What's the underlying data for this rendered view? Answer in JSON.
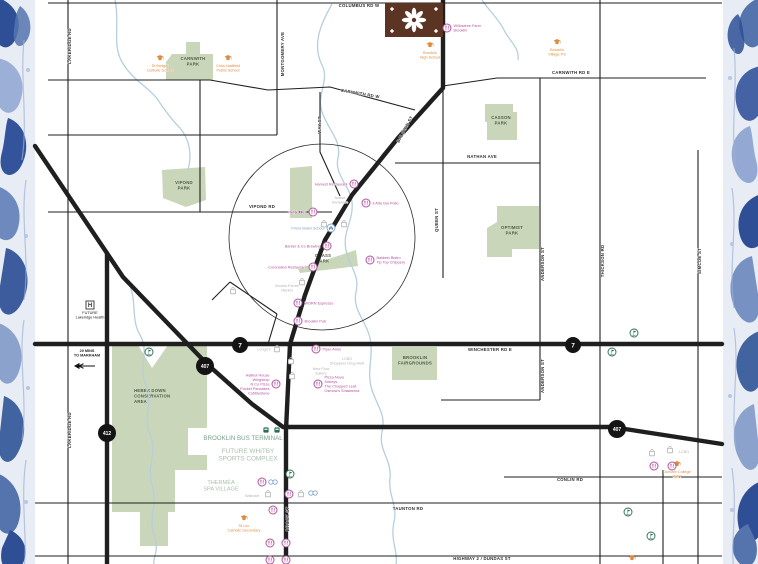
{
  "map_title": "Brooklin Whitby area amenities map",
  "colors": {
    "pink": "#b2519e",
    "orange": "#dd8c3f",
    "gray": "#b4b4b4",
    "blue": "#7fa6c9",
    "teal": "#79a189",
    "tealLight": "#a9c0ae",
    "black": "#222222",
    "green": "#2a6f4e",
    "park_fill": "#c9d6ba",
    "park_text": "#4e5c46",
    "road": "#1f1f1f",
    "stream": "#b6cede",
    "badge": "#141414",
    "logo_brown": "#5b3423"
  },
  "logo": {
    "x": 385,
    "y": 3,
    "w": 58,
    "h": 34
  },
  "circle": {
    "cx": 322,
    "cy": 237,
    "r": 93
  },
  "badges": [
    {
      "t": "7",
      "x": 240,
      "y": 345,
      "r": 8,
      "fs": 6.5
    },
    {
      "t": "7",
      "x": 573,
      "y": 345,
      "r": 8,
      "fs": 6.5
    },
    {
      "t": "407",
      "x": 205,
      "y": 366,
      "r": 9,
      "fs": 5
    },
    {
      "t": "407",
      "x": 617,
      "y": 429,
      "r": 9,
      "fs": 5
    },
    {
      "t": "412",
      "x": 107,
      "y": 433,
      "r": 9,
      "fs": 5
    }
  ],
  "roads": {
    "thin": [
      "M48,3 H722",
      "M68,0 V564",
      "M48,80 H210 L268,90 L330,87 L415,110",
      "M443,86 L497,78 H706",
      "M277,0 V135",
      "M48,135 H277",
      "M200,80 V212",
      "M48,212 H332",
      "M320,92 V152 L340,196",
      "M395,163 H540",
      "M443,90 V278",
      "M540,78 V400",
      "M600,0 V564",
      "M698,150 V564",
      "M441,400 H540",
      "M504,477 H722",
      "M663,470 V564",
      "M35,503 H722",
      "M35,556 H722",
      "M230,282 L277,314",
      "M277,314 L268,344",
      "M230,282 L212,300"
    ],
    "thick": [
      "M443,0 V88 L398,138 L352,195 L325,240 L305,295 L290,344 L286,430 V564",
      "M35,344 H722",
      "M35,146 L123,277 L207,364 L252,404 L283,427 H612 L722,444",
      "M107,253 V564"
    ]
  },
  "streams": [
    "M115,0 C120,25 112,45 122,62 C132,80 150,88 158,100 C166,112 172,120 180,128 C190,140 192,155 188,170",
    "M332,4 C320,25 312,45 322,65 C330,80 316,95 322,112 C328,130 342,140 338,158 C334,175 350,185 352,202 C354,220 342,232 346,250 C350,268 360,275 356,292 C352,310 366,320 370,338 C374,356 366,372 372,390 C378,408 386,414 382,432 C378,450 392,460 390,478 C388,496 398,505 394,522 C390,540 398,550 396,564",
    "M128,282 C138,300 130,318 140,335 C150,352 138,368 146,385 C154,402 142,418 150,435 C158,452 146,468 152,485 C158,502 148,518 154,535 C160,552 152,558 154,564",
    "M482,0 C490,12 498,18 504,30 C510,42 520,48 518,60"
  ],
  "parks": [
    {
      "label": [
        "CARNWITH",
        "PARK"
      ],
      "lx": 193,
      "ly": 60,
      "anchor": "middle",
      "d": "M172,54 L186,54 L186,42 L200,42 L200,54 L213,54 L213,80 L166,80 L166,62 Z"
    },
    {
      "label": [
        "VIPOND",
        "PARK"
      ],
      "lx": 184,
      "ly": 184,
      "anchor": "middle",
      "d": "M162,170 L205,167 L206,200 L186,207 L163,198 Z"
    },
    {
      "label": [
        "CASSON",
        "PARK"
      ],
      "lx": 501,
      "ly": 119,
      "anchor": "middle",
      "d": "M485,104 L513,104 L513,112 L517,112 L517,140 L487,140 L487,122 L485,122 Z"
    },
    {
      "label": [
        "OPTIMIST",
        "PARK"
      ],
      "lx": 512,
      "ly": 229,
      "anchor": "middle",
      "d": "M497,206 L539,206 L539,249 L512,249 L512,257 L487,257 L487,228 L497,222 Z"
    },
    {
      "label": [
        "GRASS",
        "PARK"
      ],
      "lx": 323,
      "ly": 257,
      "anchor": "middle",
      "d": "M298,269 L356,250 L358,266 L300,273 Z"
    },
    {
      "label": [
        "BROOKLIN",
        "FAIRGROUNDS"
      ],
      "lx": 415,
      "ly": 359,
      "anchor": "middle",
      "d": "M392,347 L437,347 L437,380 L392,380 Z"
    },
    {
      "label": [
        "HEBER DOWN",
        "CONSERVATION",
        "AREA"
      ],
      "lx": 134,
      "ly": 392,
      "anchor": "start",
      "d": "M112,345 L138,345 L152,368 L168,345 L207,345 L207,428 L188,428 L188,455 L207,455 L207,470 L175,470 L175,512 L168,512 L168,546 L140,546 L140,512 L112,512 Z"
    },
    {
      "label": [],
      "lx": 0,
      "ly": 0,
      "anchor": "middle",
      "d": "M290,168 L312,166 L312,218 L290,218 Z"
    }
  ],
  "streets": [
    {
      "t": "COLUMBUS RD W",
      "x": 359,
      "y": 7,
      "r": 0
    },
    {
      "t": "LAKERIDGE RD",
      "x": 71,
      "y": 46,
      "r": -90
    },
    {
      "t": "LAKERIDGE RD",
      "x": 71,
      "y": 430,
      "r": -90
    },
    {
      "t": "MONTGOMERY AVE",
      "x": 284,
      "y": 54,
      "r": -90
    },
    {
      "t": "CARNWITH RD W",
      "x": 360,
      "y": 95,
      "r": 10
    },
    {
      "t": "CARNWITH RD E",
      "x": 571,
      "y": 74,
      "r": 0
    },
    {
      "t": "WAY ST",
      "x": 321,
      "y": 125,
      "r": -90
    },
    {
      "t": "BALDWIN ST",
      "x": 406,
      "y": 130,
      "r": -62
    },
    {
      "t": "VIPOND RD",
      "x": 262,
      "y": 208,
      "r": 0
    },
    {
      "t": "NATHAN AVE",
      "x": 482,
      "y": 158,
      "r": 0
    },
    {
      "t": "QUEEN ST",
      "x": 438,
      "y": 220,
      "r": -90
    },
    {
      "t": "ANDERSON ST",
      "x": 544,
      "y": 264,
      "r": -90
    },
    {
      "t": "ANDERSON ST",
      "x": 544,
      "y": 376,
      "r": -90
    },
    {
      "t": "THICKSON RD",
      "x": 604,
      "y": 261,
      "r": -90
    },
    {
      "t": "SIMCOE ST",
      "x": 701,
      "y": 261,
      "r": -90
    },
    {
      "t": "WINCHESTER RD E",
      "x": 490,
      "y": 351,
      "r": 0
    },
    {
      "t": "CONLIN RD",
      "x": 570,
      "y": 481,
      "r": 0
    },
    {
      "t": "TAUNTON RD",
      "x": 408,
      "y": 510,
      "r": 0
    },
    {
      "t": "HIGHWAY 2 / DUNDAS ST",
      "x": 482,
      "y": 560,
      "r": 0
    },
    {
      "t": "BROCK ST",
      "x": 289,
      "y": 519,
      "r": -90
    }
  ],
  "pois": [
    {
      "type": "school",
      "x": 160,
      "y": 58,
      "side": "b",
      "color": "orange",
      "label": [
        "St Bridget",
        "Catholic School"
      ]
    },
    {
      "type": "school",
      "x": 228,
      "y": 58,
      "side": "b",
      "color": "orange",
      "label": [
        "Chris Hadfield",
        "Public School"
      ]
    },
    {
      "type": "school",
      "x": 430,
      "y": 45,
      "side": "b",
      "color": "orange",
      "label": [
        "Brooklin",
        "High School"
      ]
    },
    {
      "type": "school",
      "x": 557,
      "y": 42,
      "side": "b",
      "color": "orange",
      "label": [
        "Brooklin",
        "Village PS"
      ]
    },
    {
      "type": "school",
      "x": 244,
      "y": 518,
      "side": "b",
      "color": "orange",
      "label": [
        "St Leo",
        "Catholic Secondary"
      ]
    },
    {
      "type": "school",
      "x": 677,
      "y": 464,
      "side": "b",
      "color": "orange",
      "label": [
        "Durham College",
        "UOIT"
      ]
    },
    {
      "type": "school",
      "x": 632,
      "y": 558,
      "side": "b",
      "color": "orange",
      "label": []
    },
    {
      "type": "hospital",
      "x": 90,
      "y": 305,
      "side": "b",
      "color": "black",
      "label": [
        "FUTURE",
        "Lakeridge Health"
      ]
    },
    {
      "type": "restaurant",
      "x": 447,
      "y": 28,
      "side": "r",
      "color": "pink",
      "label": [
        "Willowtree Farm",
        "Brooklin"
      ]
    },
    {
      "type": "restaurant",
      "x": 354,
      "y": 184,
      "side": "l",
      "color": "pink",
      "label": [
        "Harvest Restaurant"
      ]
    },
    {
      "type": "restaurant",
      "x": 313,
      "y": 212,
      "side": "l",
      "color": "pink",
      "label": [
        "Holly's Deli"
      ]
    },
    {
      "type": "text",
      "x": 340,
      "y": 199,
      "color": "gray",
      "label": [
        "Native",
        "Hardware"
      ]
    },
    {
      "type": "bag",
      "x": 324,
      "y": 224,
      "color": "gray",
      "label": []
    },
    {
      "type": "bag",
      "x": 344,
      "y": 224,
      "color": "gray",
      "label": []
    },
    {
      "type": "car",
      "x": 331,
      "y": 228,
      "side": "l",
      "color": "blue",
      "label": [
        "Prima Ballet School"
      ]
    },
    {
      "type": "restaurant",
      "x": 366,
      "y": 203,
      "side": "r",
      "color": "pink",
      "label": [
        "Il Arte Del Pollo"
      ]
    },
    {
      "type": "restaurant",
      "x": 370,
      "y": 260,
      "side": "r",
      "color": "pink",
      "label": [
        "Baldwin Bistro",
        "Tip Top Chippery"
      ]
    },
    {
      "type": "restaurant",
      "x": 327,
      "y": 246,
      "side": "l",
      "color": "pink",
      "label": [
        "Barber & Co Brewing"
      ]
    },
    {
      "type": "restaurant",
      "x": 313,
      "y": 267,
      "side": "l",
      "color": "pink",
      "label": [
        "Coronation Restaurant"
      ]
    },
    {
      "type": "bag",
      "x": 302,
      "y": 282,
      "color": "gray",
      "label": []
    },
    {
      "type": "bag",
      "x": 233,
      "y": 291,
      "color": "gray",
      "label": []
    },
    {
      "type": "text",
      "x": 287,
      "y": 287,
      "color": "gray",
      "label": [
        "Brooks Farms",
        "Market"
      ]
    },
    {
      "type": "restaurant",
      "x": 298,
      "y": 303,
      "side": "r",
      "color": "pink",
      "label": [
        "WORN Espresso"
      ]
    },
    {
      "type": "restaurant",
      "x": 298,
      "y": 321,
      "side": "r",
      "color": "pink",
      "label": [
        "Brooklin Pub"
      ]
    },
    {
      "type": "bag",
      "x": 277,
      "y": 349,
      "side": "l",
      "color": "gray",
      "label": [
        "Longo's"
      ]
    },
    {
      "type": "restaurant",
      "x": 316,
      "y": 349,
      "side": "r",
      "color": "pink",
      "label": [
        "Piper Arms"
      ]
    },
    {
      "type": "bag",
      "x": 291,
      "y": 361,
      "color": "gray",
      "label": []
    },
    {
      "type": "text",
      "x": 347,
      "y": 360,
      "color": "gray",
      "label": [
        "LCBO",
        "Shoppers Drug Mart"
      ]
    },
    {
      "type": "bag",
      "x": 292,
      "y": 376,
      "color": "gray",
      "label": []
    },
    {
      "type": "text",
      "x": 321,
      "y": 370,
      "color": "gray",
      "label": [
        "New Flow",
        "Eatery"
      ]
    },
    {
      "type": "restaurant",
      "x": 276,
      "y": 384,
      "side": "l",
      "color": "pink",
      "label": [
        "Halibut House",
        "Wingshop",
        "N Co Pizza",
        "Pocket Pancakes",
        "Cobblestone"
      ]
    },
    {
      "type": "restaurant",
      "x": 318,
      "y": 384,
      "side": "r",
      "color": "pink",
      "label": [
        "Pizza Nova",
        "Sobeys",
        "The Chopped Leaf",
        "Osmow's Shawarma"
      ]
    },
    {
      "type": "bus",
      "x": 266,
      "y": 430,
      "color": "green",
      "label": []
    },
    {
      "type": "bus",
      "x": 277,
      "y": 430,
      "color": "green",
      "label": []
    },
    {
      "type": "text",
      "x": 243,
      "y": 440,
      "color": "teal",
      "fs": 6.2,
      "label": [
        "BROOKLIN BUS TERMINAL"
      ]
    },
    {
      "type": "text",
      "x": 248,
      "y": 453,
      "color": "tealLight",
      "fs": 6.4,
      "label": [
        "FUTURE WHITBY",
        "SPORTS COMPLEX"
      ]
    },
    {
      "type": "text",
      "x": 221,
      "y": 484,
      "color": "tealLight",
      "fs": 5.6,
      "label": [
        "THERMËA",
        "SPA VILLAGE"
      ]
    },
    {
      "type": "golf",
      "x": 149,
      "y": 352,
      "color": "green",
      "label": []
    },
    {
      "type": "golf",
      "x": 290,
      "y": 474,
      "color": "green",
      "label": []
    },
    {
      "type": "golf",
      "x": 612,
      "y": 352,
      "color": "green",
      "label": []
    },
    {
      "type": "golf",
      "x": 634,
      "y": 333,
      "color": "green",
      "label": []
    },
    {
      "type": "golf",
      "x": 628,
      "y": 512,
      "color": "green",
      "label": []
    },
    {
      "type": "golf",
      "x": 651,
      "y": 536,
      "color": "green",
      "label": []
    },
    {
      "type": "restaurant",
      "x": 262,
      "y": 482,
      "color": "pink",
      "label": []
    },
    {
      "type": "oo",
      "x": 273,
      "y": 482,
      "color": "blue",
      "label": []
    },
    {
      "type": "text",
      "x": 252,
      "y": 497,
      "color": "gray",
      "label": [
        "Walmart"
      ]
    },
    {
      "type": "bag",
      "x": 268,
      "y": 494,
      "color": "gray",
      "label": []
    },
    {
      "type": "restaurant",
      "x": 289,
      "y": 494,
      "color": "pink",
      "label": []
    },
    {
      "type": "bag",
      "x": 301,
      "y": 494,
      "color": "gray",
      "label": []
    },
    {
      "type": "oo",
      "x": 313,
      "y": 493,
      "color": "blue",
      "label": []
    },
    {
      "type": "restaurant",
      "x": 273,
      "y": 510,
      "color": "pink",
      "label": []
    },
    {
      "type": "restaurant",
      "x": 270,
      "y": 543,
      "color": "pink",
      "label": []
    },
    {
      "type": "restaurant",
      "x": 286,
      "y": 543,
      "color": "pink",
      "label": []
    },
    {
      "type": "restaurant",
      "x": 270,
      "y": 560,
      "color": "pink",
      "label": []
    },
    {
      "type": "restaurant",
      "x": 286,
      "y": 560,
      "color": "pink",
      "label": []
    },
    {
      "type": "bag",
      "x": 652,
      "y": 453,
      "color": "gray",
      "label": []
    },
    {
      "type": "bag",
      "x": 670,
      "y": 450,
      "color": "gray",
      "label": []
    },
    {
      "type": "text",
      "x": 684,
      "y": 453,
      "color": "gray",
      "label": [
        "LCBO"
      ]
    },
    {
      "type": "restaurant",
      "x": 654,
      "y": 466,
      "color": "pink",
      "label": []
    },
    {
      "type": "restaurant",
      "x": 672,
      "y": 466,
      "color": "pink",
      "label": []
    },
    {
      "type": "text",
      "x": 87,
      "y": 352,
      "color": "black",
      "bold": true,
      "label": [
        "20 MINS",
        "TO MARKHAM"
      ]
    },
    {
      "type": "arrow",
      "x": 85,
      "y": 366,
      "color": "black",
      "label": []
    }
  ]
}
